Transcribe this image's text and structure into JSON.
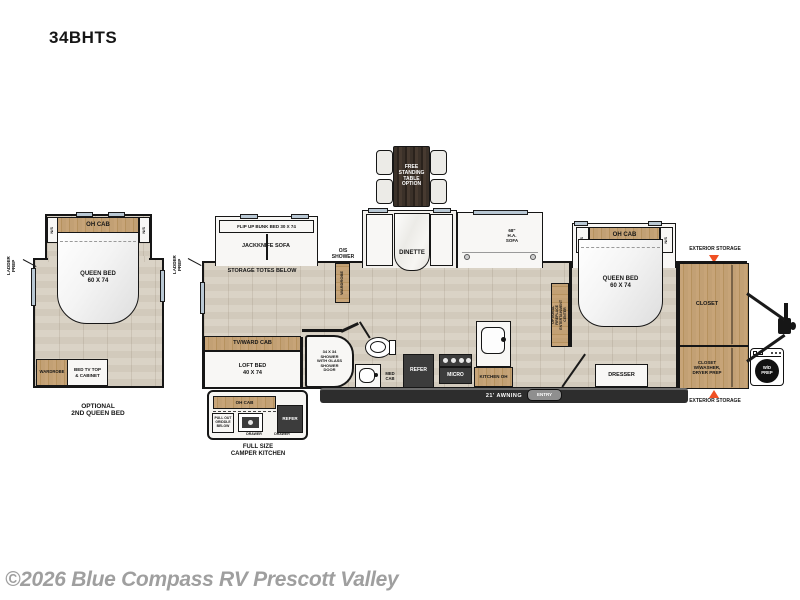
{
  "title": "34BHTS",
  "footer": {
    "copyright": "©2026 Blue Compass RV Prescott Valley"
  },
  "colors": {
    "accent_orange": "#f05023",
    "wood": "#c2a074",
    "floor": "#d6cfc2",
    "appliance_dark": "#3c3c3c",
    "window_glass": "#b9c8d4"
  },
  "left_unit": {
    "ladder_prep": "LADDER\nPREP",
    "oh_cab": "OH CAB",
    "ns": "N/S",
    "queen_bed": "QUEEN BED\n60 X 74",
    "wardrobe": "WARDROBE",
    "bed_tv": "BED TV TOP\n& CABINET",
    "caption": "OPTIONAL\n2ND QUEEN BED"
  },
  "main": {
    "ladder_prep": "LADDER\nPREP",
    "flip_up_bunk": "FLIP UP BUNK BED 30 X 74",
    "jackknife_sofa": "JACKKNIFE SOFA",
    "storage_totes": "STORAGE TOTES BELOW",
    "os_shower": "O/S\nSHOWER",
    "wardrobe": "WARDROBE",
    "tv_ward_cab": "TV/WARD CAB",
    "loft_bed": "LOFT BED\n40 X 74",
    "table_option": "FREE\nSTANDING\nTABLE\nOPTION",
    "dinette": "DINETTE",
    "sofa": "68\"\nH.A.\nSOFA",
    "shower": "34 X 34\nSHOWER\nWITH GLASS\nSHOWER\nDOOR",
    "med_cab": "MED\nCAB",
    "refer": "REFER",
    "micro": "MICRO",
    "kitchen_oh": "KITCHEN OH",
    "awning": "21' AWNING",
    "entry": "ENTRY",
    "bedroom": {
      "oh_cab": "OH CAB",
      "ns": "N/S",
      "queen_bed": "QUEEN BED\n60 X 74",
      "ent_center": "ENTERTAINMENT\nCENTER",
      "opt_fireplace": "OPTIONAL\nFIREPLACE",
      "dresser": "DRESSER"
    },
    "rear": {
      "closet": "CLOSET",
      "closet_wd": "CLOSET\nW/WASHER,\nDRYER PREP",
      "ext_storage_top": "EXTERIOR STORAGE",
      "ext_storage_bottom": "EXTERIOR STORAGE",
      "wd_prep": "W/D\nPREP"
    }
  },
  "camper_kitchen": {
    "oh_cab": "OH CAB",
    "griddle": "PULL OUT\nGRIDDLE\nBELOW",
    "refer": "REFER",
    "drawer_left": "DRAWER",
    "drawer_right": "DRAWER",
    "caption": "FULL SIZE\nCAMPER KITCHEN"
  }
}
